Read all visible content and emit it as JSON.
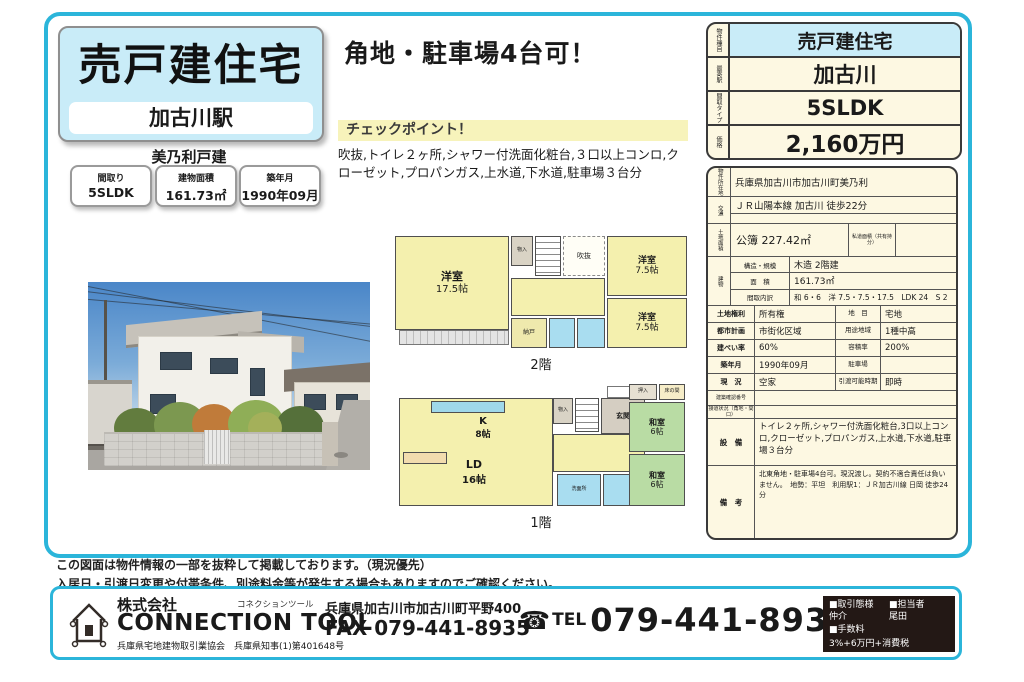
{
  "colors": {
    "accent_cyan": "#2bb5da",
    "light_blue": "#c9ecf8",
    "cream": "#fdf8e2",
    "highlight_yellow": "#f7f3bb",
    "plan_yellow": "#f4f0ae",
    "plan_green": "#b9dca4",
    "plan_blue": "#a9ddf0",
    "footer_black": "#231815"
  },
  "header": {
    "property_type": "売戸建住宅",
    "station": "加古川駅",
    "building_name": "美乃利戸建",
    "specs": [
      {
        "label": "間取り",
        "value": "5SLDK"
      },
      {
        "label": "建物面積",
        "value": "161.73㎡"
      },
      {
        "label": "築年月",
        "value": "1990年09月"
      }
    ]
  },
  "catch": {
    "headline": "角地・駐車場4台可！",
    "checkpoint_title": "チェックポイント！",
    "checkpoint_text": "吹抜,トイレ２ヶ所,シャワー付洗面化粧台,３口以上コンロ,クローゼット,プロパンガス,上水道,下水道,駐車場３台分"
  },
  "plan2f": {
    "caption": "2階",
    "rooms": {
      "west_name": "洋室",
      "west_size": "17.5帖",
      "ne_name": "洋室",
      "ne_size": "7.5帖",
      "se_name": "洋室",
      "se_size": "7.5帖",
      "void": "吹抜",
      "closet": "物入",
      "storage": "納戸"
    }
  },
  "plan1f": {
    "caption": "1階",
    "rooms": {
      "kitchen_name": "K",
      "kitchen_size": "8帖",
      "ld_name": "LD",
      "ld_size": "16帖",
      "entrance": "玄関",
      "closet": "物入",
      "oshiire": "押入",
      "tokonoma": "床の間",
      "wa_north_name": "和室",
      "wa_north_size": "6帖",
      "wa_south_name": "和室",
      "wa_south_size": "6帖",
      "wash": "洗面所"
    }
  },
  "price_table": {
    "rows": [
      {
        "label": "物件種目",
        "value": "売戸建住宅"
      },
      {
        "label": "最寄駅",
        "value": "加古川"
      },
      {
        "label": "間取タイプ",
        "value": "5SLDK"
      },
      {
        "label": "価格",
        "value": "2,160万円"
      }
    ]
  },
  "details": {
    "address_label": "物件所在地",
    "address": "兵庫県加古川市加古川町美乃利",
    "access_label": "交通",
    "access": "ＪＲ山陽本線 加古川 徒歩22分",
    "access2": "",
    "land_label": "土地面積",
    "land_value": "公簿 227.42㎡",
    "private_road_label": "私道面積（共有持分）",
    "private_road_value": "",
    "building_label": "建物",
    "building_rows": [
      {
        "label": "構造・規模",
        "value": "木造 2階建"
      },
      {
        "label": "面　積",
        "value": "161.73㎡"
      },
      {
        "label": "間取内訳",
        "value": "和 6・6　洋 7.5・7.5・17.5　LDK 24　S 2"
      }
    ],
    "pairs": [
      {
        "l1": "土地権利",
        "v1": "所有権",
        "l2": "地　目",
        "v2": "宅地"
      },
      {
        "l1": "都市計画",
        "v1": "市街化区域",
        "l2": "用途地域",
        "v2": "1種中高"
      },
      {
        "l1": "建ぺい率",
        "v1": "60%",
        "l2": "容積率",
        "v2": "200%"
      },
      {
        "l1": "築年月",
        "v1": "1990年09月",
        "l2": "駐車場",
        "v2": ""
      },
      {
        "l1": "現　況",
        "v1": "空家",
        "l2": "引渡可能時期",
        "v2": "即時"
      }
    ],
    "confirm_label": "建築確認番号",
    "confirm_value": "",
    "road_label": "接道状況（角地・間口）",
    "road_value": "",
    "equipment_label": "設　備",
    "equipment": "トイレ２ヶ所,シャワー付洗面化粧台,3口以上コンロ,クローゼット,プロパンガス,上水道,下水道,駐車場３台分",
    "remarks_label": "備　考",
    "remarks": "北東角地・駐車場4台可。現況渡し。契約不適合責任は負いません。　地勢：平坦　利用駅1：ＪＲ加古川線 日岡 徒歩24分"
  },
  "footer": {
    "note1": "この図面は物件情報の一部を抜粋して掲載しております。（現況優先）",
    "note2": "入居日・引渡日変更や付帯条件、別途料金等が発生する場合もありますのでご確認ください。",
    "company_prefix": "株式会社",
    "company_kana": "コネクションツール",
    "company_name": "CONNECTION TOOL",
    "license": "兵庫県宅地建物取引業協会　兵庫県知事(1)第401648号",
    "address": "兵庫県加古川市加古川町平野400",
    "fax": "FAX 079-441-8935",
    "tel_icon": "☎",
    "tel_label": "TEL",
    "tel": "079-441-8934",
    "deal_mode_label": "■取引態様",
    "deal_mode": "仲介",
    "staff_label": "■担当者",
    "staff": "尾田",
    "fee_label": "■手数料",
    "fee": "3%+6万円+消費税"
  }
}
